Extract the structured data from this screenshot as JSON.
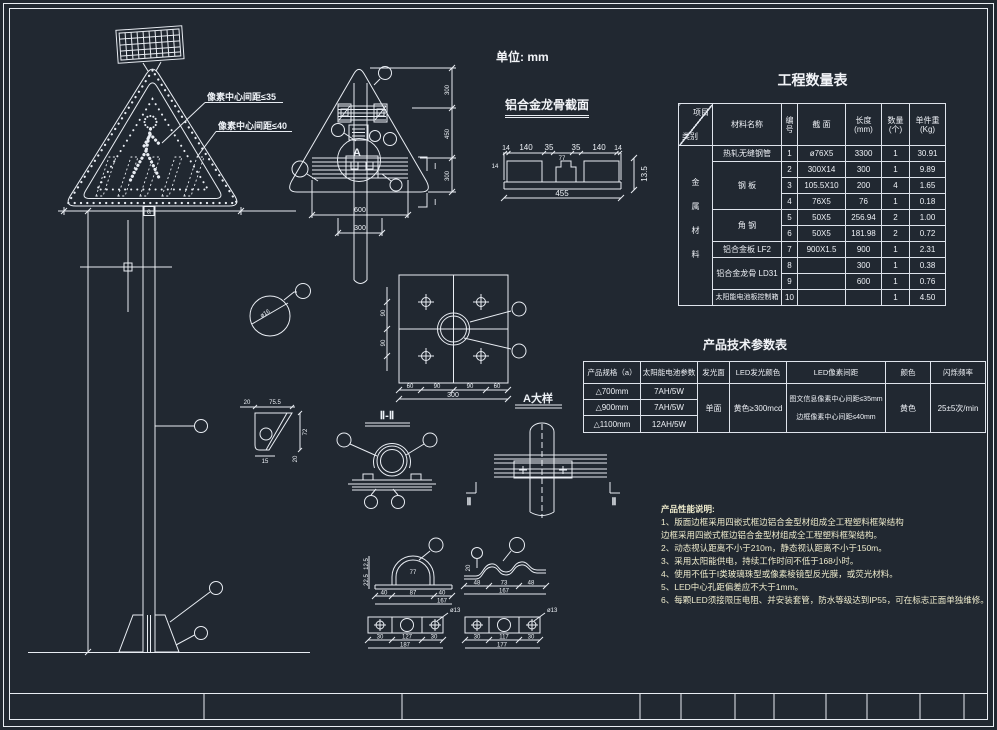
{
  "unit_label": "单位: mm",
  "front_view": {
    "pixel_pitch_pictogram": "像素中心间距≤35",
    "pixel_pitch_border": "像素中心间距≤40",
    "width_dim": "a"
  },
  "rear_view": {
    "detail_mark": "A",
    "section_mark": "Ⅰ",
    "dim_width": "600",
    "dim_post": "300",
    "dims_height": [
      "300",
      "450",
      "300"
    ]
  },
  "keel_section": {
    "title": "铝合金龙骨截面",
    "dims_top": [
      "14",
      "140",
      "35",
      "77",
      "35",
      "140",
      "14"
    ],
    "dim_left": "14",
    "dim_total": "455",
    "dim_height": "13.5"
  },
  "phi16_detail": {
    "label": "ø16"
  },
  "gusset_detail": {
    "dim_top_left": "20",
    "dim_top_right": "75.5",
    "dim_right": "72",
    "dim_bottom": "15",
    "dim_bottom_right": "20"
  },
  "plate_section": {
    "dims_bottom": [
      "60",
      "90",
      "90",
      "60"
    ],
    "dim_total": "300",
    "dims_left": [
      "90",
      "90"
    ]
  },
  "section_ii": {
    "label": "Ⅱ-Ⅱ"
  },
  "detail_a": {
    "label": "A大样",
    "section_mark": "Ⅱ"
  },
  "saddle_clamp": {
    "dim_inner": "77",
    "dims_bottom": [
      "40",
      "87",
      "40"
    ],
    "dim_total": "167",
    "dims_left": [
      "12.5",
      "22.5"
    ]
  },
  "wave_clamp": {
    "dims_bottom": [
      "48",
      "73",
      "48"
    ],
    "dim_total": "167",
    "dim_left": "20"
  },
  "plate_left": {
    "hole_label": "ø13",
    "dims_bottom": [
      "30",
      "127",
      "30"
    ],
    "dim_total": "187"
  },
  "plate_right": {
    "hole_label": "ø13",
    "dims_bottom": [
      "30",
      "117",
      "30"
    ],
    "dim_total": "177"
  },
  "quantity_table": {
    "title": "工程数量表",
    "corner": {
      "top": "项目",
      "bottom": "类别"
    },
    "headers": {
      "material": "材料名称",
      "no": "编\n号",
      "section": "截 面",
      "length": "长度\n(mm)",
      "qty": "数量\n(个)",
      "unit_weight": "单件重\n(Kg)"
    },
    "category": "金属材料",
    "materials": [
      "热轧无缝钢管",
      "钢 板",
      "角 钢",
      "铝合金板 LF2",
      "铝合金龙骨 LD31",
      "太阳能电池板控制箱"
    ],
    "rows": [
      {
        "no": "1",
        "section": "ø76X5",
        "length": "3300",
        "qty": "1",
        "weight": "30.91"
      },
      {
        "no": "2",
        "section": "300X14",
        "length": "300",
        "qty": "1",
        "weight": "9.89"
      },
      {
        "no": "3",
        "section": "105.5X10",
        "length": "200",
        "qty": "4",
        "weight": "1.65"
      },
      {
        "no": "4",
        "section": "76X5",
        "length": "76",
        "qty": "1",
        "weight": "0.18"
      },
      {
        "no": "5",
        "section": "50X5",
        "length": "256.94",
        "qty": "2",
        "weight": "1.00"
      },
      {
        "no": "6",
        "section": "50X5",
        "length": "181.98",
        "qty": "2",
        "weight": "0.72"
      },
      {
        "no": "7",
        "section": "900X1.5",
        "length": "900",
        "qty": "1",
        "weight": "2.31"
      },
      {
        "no": "8",
        "section": "",
        "length": "300",
        "qty": "1",
        "weight": "0.38"
      },
      {
        "no": "9",
        "section": "",
        "length": "600",
        "qty": "1",
        "weight": "0.76"
      },
      {
        "no": "10",
        "section": "",
        "length": "",
        "qty": "1",
        "weight": "4.50"
      }
    ]
  },
  "params_table": {
    "title": "产品技术参数表",
    "headers": [
      "产品规格（a）",
      "太阳能电池参数",
      "发光面",
      "LED发光颜色",
      "LED像素间距",
      "颜色",
      "闪烁频率"
    ],
    "rows": [
      {
        "spec": "△700mm",
        "battery": "7AH/5W"
      },
      {
        "spec": "△900mm",
        "battery": "7AH/5W"
      },
      {
        "spec": "△1100mm",
        "battery": "12AH/5W"
      }
    ],
    "face": "单面",
    "led_color": "黄色≥300mcd",
    "pitch_line1": "图文信息像素中心间距≤35mm",
    "pitch_line2": "边框像素中心间距≤40mm",
    "color": "黄色",
    "flash": "25±5次/min"
  },
  "notes": {
    "title": "产品性能说明:",
    "lines": [
      "1、版面边框采用四嵌式框边铝合金型材组成全工程塑料框架结构",
      "边框采用四嵌式框边铝合金型材组成全工程塑料框架结构。",
      "2、动态视认距离不小于210m，静态视认距离不小于150m。",
      "3、采用太阳能供电，持续工作时间不低于168小时。",
      "4、使用不低于Ⅰ类玻璃珠型或像素棱镜型反光膜，或荧光材料。",
      "5、LED中心孔距偏差应不大于1mm。",
      "6、每颗LED须接限压电阻、并安装套管，防水等级达到IP55，可在标志正面单独维修。"
    ]
  }
}
